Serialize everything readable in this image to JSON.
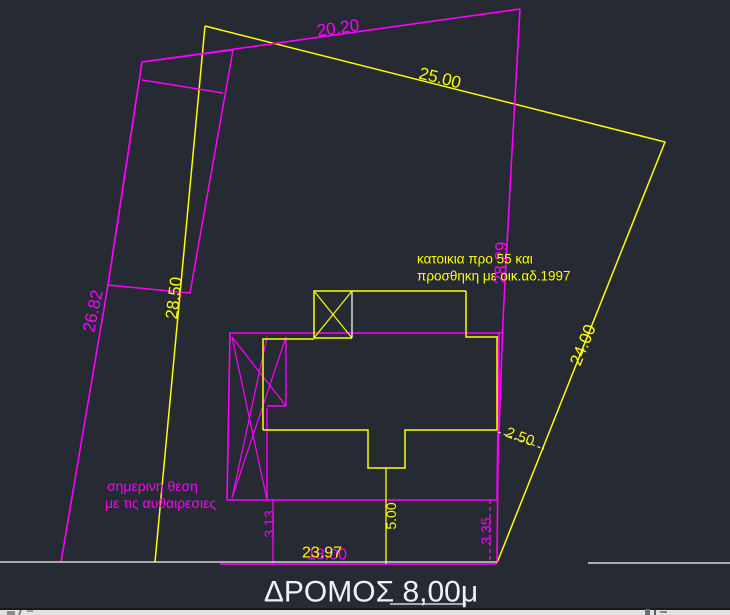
{
  "app": {
    "background": "#252a33",
    "statusbar_bg": "#e2e2e2"
  },
  "colors": {
    "magenta": "#ff00ff",
    "yellow": "#ffff00",
    "white": "#f5f5f5",
    "road_text": "#eef2f5"
  },
  "drawing": {
    "lines": [
      {
        "name": "parcel-yellow-side-25-24",
        "color": "#ffff00",
        "width": 1.5,
        "points": [
          [
            205,
            26
          ],
          [
            665,
            142
          ],
          [
            497,
            563
          ]
        ]
      },
      {
        "name": "parcel-yellow-side-28-50",
        "color": "#ffff00",
        "width": 1.5,
        "points": [
          [
            205,
            26
          ],
          [
            155,
            562
          ]
        ]
      },
      {
        "name": "parcel-yellow-vertex-tick",
        "color": "#ffff00",
        "width": 1.3,
        "points": [
          [
            205,
            26
          ],
          [
            221,
            30
          ]
        ]
      },
      {
        "name": "parcel-magenta-top-side",
        "color": "#ff00ff",
        "width": 1.6,
        "points": [
          [
            142,
            62
          ],
          [
            520,
            9
          ]
        ]
      },
      {
        "name": "parcel-magenta-right-side",
        "color": "#ff00ff",
        "width": 1.6,
        "points": [
          [
            520,
            9
          ],
          [
            511,
            170
          ],
          [
            503,
            320
          ],
          [
            498,
            460
          ],
          [
            497,
            563
          ]
        ]
      },
      {
        "name": "parcel-magenta-left-side",
        "color": "#ff00ff",
        "width": 1.6,
        "points": [
          [
            142,
            62
          ],
          [
            108,
            285
          ],
          [
            61,
            562
          ]
        ]
      },
      {
        "name": "parcel-magenta-bottom-side",
        "color": "#ff00ff",
        "width": 1.5,
        "points": [
          [
            220,
            564
          ],
          [
            497,
            564
          ]
        ]
      },
      {
        "name": "neighbor-strip-outline",
        "color": "#ff00ff",
        "width": 1.5,
        "points": [
          [
            142,
            62
          ],
          [
            233,
            50
          ],
          [
            190,
            293
          ],
          [
            108,
            285
          ],
          [
            142,
            62
          ]
        ]
      },
      {
        "name": "neighbor-strip-divider",
        "color": "#ff00ff",
        "width": 1.4,
        "points": [
          [
            142,
            80
          ],
          [
            223,
            93
          ]
        ]
      },
      {
        "name": "building-magenta-top",
        "color": "#ff00ff",
        "width": 1.6,
        "points": [
          [
            229,
            333
          ],
          [
            502,
            333
          ]
        ]
      },
      {
        "name": "building-magenta-right",
        "color": "#ff00ff",
        "width": 1.6,
        "points": [
          [
            499,
            333
          ],
          [
            497,
            500
          ]
        ]
      },
      {
        "name": "building-magenta-bottom",
        "color": "#ff00ff",
        "width": 1.6,
        "points": [
          [
            227,
            500
          ],
          [
            497,
            500
          ]
        ]
      },
      {
        "name": "building-magenta-left",
        "color": "#ff00ff",
        "width": 1.6,
        "points": [
          [
            230,
            333
          ],
          [
            227,
            500
          ]
        ]
      },
      {
        "name": "building-magenta-column-right",
        "color": "#ff00ff",
        "width": 1.4,
        "points": [
          [
            267,
            408
          ],
          [
            267,
            500
          ]
        ]
      },
      {
        "name": "building-magenta-smallrect-right",
        "color": "#ff00ff",
        "width": 1.4,
        "points": [
          [
            286,
            337
          ],
          [
            286,
            406
          ]
        ]
      },
      {
        "name": "building-magenta-smallrect-bottom",
        "color": "#ff00ff",
        "width": 1.4,
        "points": [
          [
            267,
            406
          ],
          [
            286,
            406
          ]
        ]
      },
      {
        "name": "building-magenta-diagonal-a",
        "color": "#ff00ff",
        "width": 1.2,
        "points": [
          [
            232,
            337
          ],
          [
            286,
            406
          ]
        ]
      },
      {
        "name": "building-magenta-diagonal-b",
        "color": "#ff00ff",
        "width": 1.2,
        "points": [
          [
            286,
            337
          ],
          [
            232,
            498
          ]
        ]
      },
      {
        "name": "building-magenta-diagonal-c",
        "color": "#ff00ff",
        "width": 1.2,
        "points": [
          [
            232,
            337
          ],
          [
            267,
            500
          ]
        ]
      },
      {
        "name": "building-magenta-diagonal-d",
        "color": "#ff00ff",
        "width": 1.2,
        "points": [
          [
            232,
            498
          ],
          [
            267,
            337
          ]
        ]
      },
      {
        "name": "building-yellow-left",
        "color": "#ffff00",
        "width": 1.5,
        "points": [
          [
            263,
            430
          ],
          [
            263,
            339
          ],
          [
            314,
            339
          ]
        ]
      },
      {
        "name": "building-yellow-stair-square",
        "color": "#ffff00",
        "width": 1.5,
        "points": [
          [
            314,
            338
          ],
          [
            314,
            291
          ],
          [
            352,
            291
          ]
        ]
      },
      {
        "name": "building-yellow-stair-square-bottom",
        "color": "#ffff00",
        "width": 1.5,
        "points": [
          [
            314,
            338
          ],
          [
            352,
            338
          ]
        ]
      },
      {
        "name": "stair-square-diagonal-1",
        "color": "#ffff00",
        "width": 1.2,
        "points": [
          [
            314,
            291
          ],
          [
            352,
            338
          ]
        ]
      },
      {
        "name": "stair-square-diagonal-2",
        "color": "#ffff00",
        "width": 1.2,
        "points": [
          [
            352,
            291
          ],
          [
            314,
            338
          ]
        ]
      },
      {
        "name": "stair-square-right-white",
        "color": "#f5f5f5",
        "width": 1.3,
        "points": [
          [
            352,
            291
          ],
          [
            352,
            338
          ]
        ]
      },
      {
        "name": "building-yellow-top",
        "color": "#ffff00",
        "width": 1.5,
        "points": [
          [
            352,
            291
          ],
          [
            466,
            291
          ]
        ]
      },
      {
        "name": "building-yellow-right-upper-step",
        "color": "#ffff00",
        "width": 1.5,
        "points": [
          [
            466,
            291
          ],
          [
            466,
            337
          ],
          [
            498,
            337
          ]
        ]
      },
      {
        "name": "building-yellow-right",
        "color": "#ffff00",
        "width": 1.5,
        "points": [
          [
            497,
            337
          ],
          [
            497,
            430
          ]
        ]
      },
      {
        "name": "building-yellow-bottom-notch",
        "color": "#ffff00",
        "width": 1.5,
        "points": [
          [
            497,
            430
          ],
          [
            405,
            430
          ],
          [
            405,
            468
          ],
          [
            368,
            468
          ],
          [
            368,
            430
          ],
          [
            263,
            430
          ]
        ]
      },
      {
        "name": "dim-line-3-13",
        "color": "#ff00ff",
        "width": 1.3,
        "points": [
          [
            273,
            500
          ],
          [
            273,
            564
          ]
        ]
      },
      {
        "name": "dim-line-5-00",
        "color": "#ffff00",
        "width": 1.3,
        "points": [
          [
            386,
            468
          ],
          [
            386,
            564
          ]
        ]
      },
      {
        "name": "dim-line-3-35",
        "color": "#ff00ff",
        "width": 1.3,
        "dash": "4,3",
        "points": [
          [
            490,
            500
          ],
          [
            490,
            564
          ]
        ]
      },
      {
        "name": "leader-2-50",
        "color": "#f5f5f5",
        "width": 1.1,
        "dash": "3,3",
        "points": [
          [
            498,
            432
          ],
          [
            544,
            449
          ]
        ]
      },
      {
        "name": "road-edge-left",
        "color": "#f5f5f5",
        "width": 1.3,
        "points": [
          [
            0,
            562
          ],
          [
            497,
            562
          ]
        ]
      },
      {
        "name": "road-edge-right",
        "color": "#f5f5f5",
        "width": 1.3,
        "points": [
          [
            588,
            563
          ],
          [
            730,
            563
          ]
        ]
      },
      {
        "name": "road-edge-under-label",
        "color": "#f5f5f5",
        "width": 1.3,
        "points": [
          [
            390,
            604
          ],
          [
            466,
            604
          ]
        ]
      }
    ],
    "texts": [
      {
        "name": "dim-text-20-20",
        "text": "20.20",
        "x": 338,
        "y": 28,
        "rot": -8,
        "size": 17,
        "color": "#ff00ff",
        "anchor": "middle"
      },
      {
        "name": "dim-text-25-00",
        "text": "25.00",
        "x": 440,
        "y": 78,
        "rot": 14,
        "size": 17,
        "color": "#ffff00",
        "anchor": "middle"
      },
      {
        "name": "dim-text-26-82",
        "text": "26.82",
        "x": 93,
        "y": 311,
        "rot": -78,
        "size": 17,
        "color": "#ff00ff",
        "anchor": "middle"
      },
      {
        "name": "dim-text-28-50",
        "text": "28.50",
        "x": 174,
        "y": 298,
        "rot": -83,
        "size": 17,
        "color": "#ffff00",
        "anchor": "middle"
      },
      {
        "name": "dim-text-28-29",
        "text": "28.29",
        "x": 501,
        "y": 263,
        "rot": -88,
        "size": 17,
        "color": "#ff00ff",
        "anchor": "middle"
      },
      {
        "name": "dim-text-24-00",
        "text": "24.00",
        "x": 583,
        "y": 345,
        "rot": -68,
        "size": 17,
        "color": "#ffff00",
        "anchor": "middle"
      },
      {
        "name": "dim-text-2-50",
        "text": "2.50",
        "x": 520,
        "y": 437,
        "rot": 20,
        "size": 15,
        "color": "#ffff00",
        "anchor": "middle"
      },
      {
        "name": "dim-text-3-13",
        "text": "3.13",
        "x": 269,
        "y": 524,
        "rot": -90,
        "size": 14,
        "color": "#ff00ff",
        "anchor": "middle"
      },
      {
        "name": "dim-text-5-00",
        "text": "5.00",
        "x": 391,
        "y": 516,
        "rot": -90,
        "size": 14,
        "color": "#ffff00",
        "anchor": "middle"
      },
      {
        "name": "dim-text-3-35",
        "text": "3.35",
        "x": 486,
        "y": 531,
        "rot": -90,
        "size": 14,
        "color": "#ff00ff",
        "anchor": "middle"
      },
      {
        "name": "dim-text-18-00",
        "text": "18.00",
        "x": 327,
        "y": 555,
        "rot": 0,
        "size": 16,
        "color": "#ff00ff",
        "anchor": "middle"
      },
      {
        "name": "dim-text-23-97",
        "text": "23.97",
        "x": 322,
        "y": 553,
        "rot": 0,
        "size": 16,
        "color": "#ffff00",
        "anchor": "middle"
      },
      {
        "name": "note-katoikia-line1",
        "text": "κατοικια προ 55 και",
        "x": 417,
        "y": 259,
        "rot": 0,
        "size": 13.5,
        "color": "#ffff00",
        "anchor": "start"
      },
      {
        "name": "note-katoikia-line2",
        "text": "προσθηκη με οικ.αδ.1997",
        "x": 417,
        "y": 276,
        "rot": 0,
        "size": 13.5,
        "color": "#ffff00",
        "anchor": "start"
      },
      {
        "name": "note-simerini-line1",
        "text": "σημερινη θεση",
        "x": 107,
        "y": 486,
        "rot": 0,
        "size": 14,
        "color": "#ff00ff",
        "anchor": "start"
      },
      {
        "name": "note-simerini-line2",
        "text": "με τις αυθαιρεσιες",
        "x": 105,
        "y": 503,
        "rot": 0,
        "size": 14,
        "color": "#ff00ff",
        "anchor": "start"
      },
      {
        "name": "road-label",
        "text": "ΔΡΟΜΟΣ 8,00μ",
        "x": 371,
        "y": 592,
        "rot": 0,
        "size": 30,
        "color": "#eef2f5",
        "anchor": "middle"
      }
    ]
  }
}
